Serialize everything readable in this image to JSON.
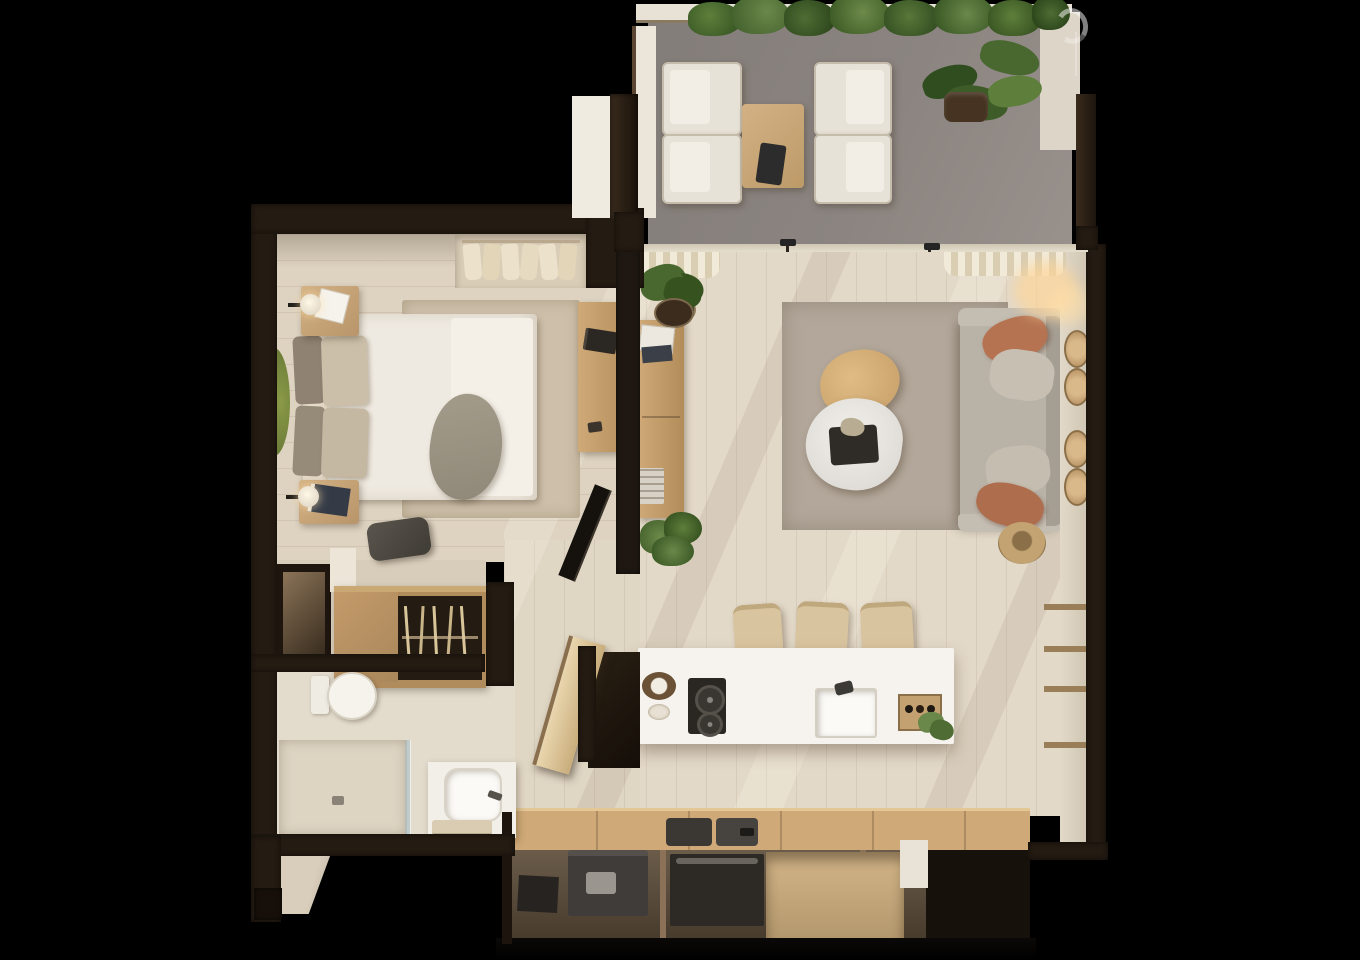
{
  "title": "3d-apartment-floor-plan-render",
  "palette": {
    "background": "#000000",
    "wall_dark": "#241b12",
    "wall_darker": "#150f09",
    "wall_face": "#f0ebe1",
    "floor_bed": "#ded3c1",
    "floor_liv": "#e3d9c8",
    "floor_bath": "#e3dbcc",
    "floor_hall": "#e0d6c4",
    "terrace": "#8b8480",
    "rug_liv": "#b2a79a",
    "rug_bed": "#cdbfa9",
    "duvet": "#efeae1",
    "marble": "#eae8e4",
    "island": "#f6f3ee",
    "furn_white": "#efeadf",
    "wood_light": "#d5ad74",
    "wood_mid": "#b08b5c",
    "wood_pale": "#e3cda4",
    "sofa": "#b9b2a7",
    "terracotta": "#b57352",
    "pillow_gray": "#c7c0b2",
    "plant_dark": "#3e5c28",
    "plant_light": "#69884a",
    "glow": "#ffd9a0",
    "track": "#d9d0c0",
    "curtain": "#eee5d0",
    "appl": "#35312c"
  },
  "scene": {
    "type": "top-down 3d rendered floor plan of a one-bedroom apartment on black background",
    "watermark": "faint partial white circle glyph, top-right of terrace wall",
    "rooms": [
      {
        "name": "terrace",
        "floor": "gray outdoor tile",
        "furniture": [
          "four white lounge chairs",
          "wood outdoor coffee table with dark tray",
          "large potted plant",
          "planter hedge along top wall"
        ]
      },
      {
        "name": "bedroom",
        "floor": "light wood planks",
        "furniture": [
          "double bed with white duvet and taupe throw",
          "headboard pillows",
          "two wood nightstands with lamps",
          "beige rug",
          "wood desk with laptop",
          "dark bench pouf",
          "open closet niche with hanging clothes"
        ]
      },
      {
        "name": "living-room",
        "floor": "light wood planks with sun streaks",
        "furniture": [
          "gray sofa with terracotta and gray cushions",
          "organic wood coffee table",
          "organic marble coffee table with dark tray",
          "large taupe area rug",
          "wood console with plant and books",
          "leaning tv panel",
          "woven basket",
          "round rattan wall decor",
          "wall shelves"
        ]
      },
      {
        "name": "kitchen",
        "floor": "light wood planks",
        "furniture": [
          "white island with two-burner cooktop, sink, fruit bowl, wine crate and plant",
          "three bar stools",
          "lower counter row with coffee machine, oven and open shelving"
        ]
      },
      {
        "name": "bathroom",
        "floor": "beige tile",
        "furniture": [
          "toilet",
          "walk-in shower with glass panel",
          "white vanity with vessel sink and towel"
        ]
      },
      {
        "name": "wardrobe-hall",
        "furniture": [
          "built-in wardrobe with hanger rail",
          "dark laundry niche",
          "entry steps at bottom-left"
        ]
      }
    ]
  }
}
